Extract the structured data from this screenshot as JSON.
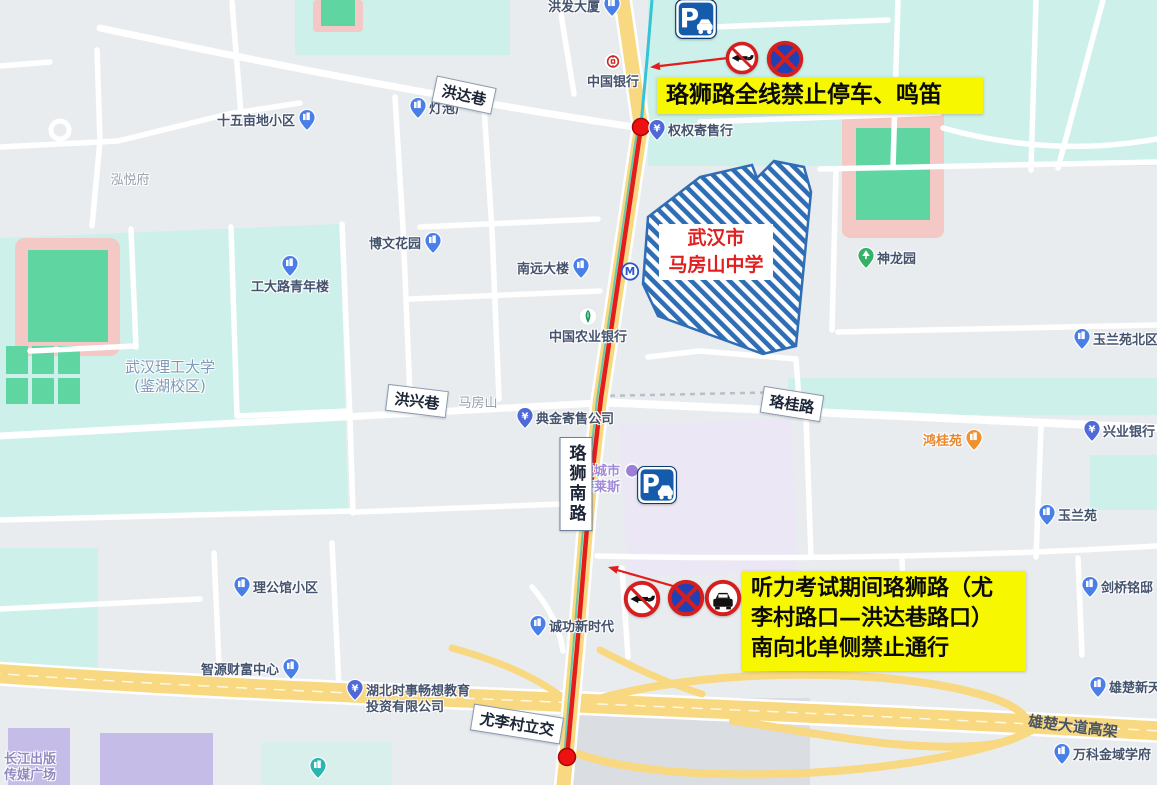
{
  "colors": {
    "map_background": "#e9ecef",
    "campus_teal": "#cdf0ea",
    "field_green": "#5fd6a2",
    "track_pink": "#f3c8c5",
    "mall_lavender": "#ebe7f5",
    "road_yellow": "#f8d880",
    "metro_cyan": "#35c3d5",
    "route_red": "#e31c1c",
    "note_yellow": "#f7f700",
    "school_hatch_blue": "#2f6db5",
    "school_text_red": "#e02020"
  },
  "school": {
    "label_lines": [
      "武汉市",
      "马房山中学"
    ]
  },
  "annotations": {
    "no_parking_horn": {
      "lines": [
        "珞狮路全线禁止停车、鸣笛"
      ]
    },
    "exam_closure": {
      "lines": [
        "听力考试期间珞狮路（尤",
        "李村路口—洪达巷路口）",
        "南向北单侧禁止通行"
      ]
    }
  },
  "road_labels": [
    {
      "name": "road-label-hongda-alley",
      "text": "洪达巷",
      "x": 464,
      "y": 95,
      "rot": 12,
      "style": "box"
    },
    {
      "name": "road-label-hongxing-alley",
      "text": "洪兴巷",
      "x": 417,
      "y": 401,
      "rot": 7,
      "style": "box"
    },
    {
      "name": "road-label-luogui-road",
      "text": "珞桂路",
      "x": 792,
      "y": 404,
      "rot": 9,
      "style": "box"
    },
    {
      "name": "road-label-luoshi-south-road",
      "text": "珞狮南路",
      "x": 576,
      "y": 484,
      "rot": 0,
      "style": "box-vertical"
    },
    {
      "name": "road-label-youlicun-interchange",
      "text": "尤李村立交",
      "x": 517,
      "y": 724,
      "rot": 9,
      "style": "box"
    },
    {
      "name": "road-label-xiongchu-avenue-viaduct",
      "text": "雄楚大道高架",
      "x": 1073,
      "y": 726,
      "rot": 7,
      "style": "on-road"
    }
  ],
  "pois": [
    {
      "name": "hongfa-building",
      "lines": [
        "洪发大厦"
      ],
      "icon": "drop-building",
      "x": 612,
      "y": 8,
      "side": "left"
    },
    {
      "name": "bank-of-china",
      "lines": [
        "中国银行"
      ],
      "icon": "circle-boc",
      "x": 613,
      "y": 63,
      "side": "below"
    },
    {
      "name": "quanquan-consignment-shop",
      "lines": [
        "权权寄售行"
      ],
      "icon": "drop-yen",
      "x": 657,
      "y": 132,
      "side": "right"
    },
    {
      "name": "dengpaochang",
      "lines": [
        "灯泡厂"
      ],
      "icon": "drop-building",
      "x": 418,
      "y": 110,
      "side": "right"
    },
    {
      "name": "shiwumudi-community",
      "lines": [
        "十五亩地小区"
      ],
      "icon": "drop-building",
      "x": 307,
      "y": 122,
      "side": "left"
    },
    {
      "name": "hongyuefu",
      "lines": [
        "泓悦府"
      ],
      "icon": "none",
      "x": 130,
      "y": 181,
      "side": "center",
      "cls": "gray"
    },
    {
      "name": "bowen-garden",
      "lines": [
        "博文花园"
      ],
      "icon": "drop-building",
      "x": 433,
      "y": 245,
      "side": "left"
    },
    {
      "name": "gongdalu-youth-building",
      "lines": [
        "工大路青年楼"
      ],
      "icon": "drop-building",
      "x": 290,
      "y": 268,
      "side": "below"
    },
    {
      "name": "wuhan-university-of-technology",
      "lines": [
        "武汉理工大学",
        "(鉴湖校区)"
      ],
      "icon": "none",
      "x": 170,
      "y": 377,
      "side": "center",
      "cls": "campus"
    },
    {
      "name": "nanyuan-building",
      "lines": [
        "南远大楼"
      ],
      "icon": "drop-building",
      "x": 581,
      "y": 270,
      "side": "left"
    },
    {
      "name": "agricultural-bank-of-china",
      "lines": [
        "中国农业银行"
      ],
      "icon": "circle-abc",
      "x": 588,
      "y": 318,
      "side": "below"
    },
    {
      "name": "metro-station",
      "lines": [],
      "icon": "circle-metro",
      "x": 630,
      "y": 273,
      "side": "right"
    },
    {
      "name": "mafangshan",
      "lines": [
        "马房山"
      ],
      "icon": "none",
      "x": 478,
      "y": 404,
      "side": "center",
      "cls": "gray"
    },
    {
      "name": "dianjin-consignment-company",
      "lines": [
        "典金寄售公司"
      ],
      "icon": "drop-yen",
      "x": 525,
      "y": 420,
      "side": "right"
    },
    {
      "name": "yuecheng-telaisi-mall",
      "lines": [
        "悦城市",
        "特莱斯"
      ],
      "icon": "circle-purple",
      "x": 632,
      "y": 472,
      "side": "left",
      "cls": "mall"
    },
    {
      "name": "honggui-garden",
      "lines": [
        "鸿桂苑"
      ],
      "icon": "drop-orange",
      "x": 974,
      "y": 442,
      "side": "left",
      "cls": "orange"
    },
    {
      "name": "industrial-bank",
      "lines": [
        "兴业银行"
      ],
      "icon": "drop-yen",
      "x": 1092,
      "y": 433,
      "side": "right"
    },
    {
      "name": "yulanyuan-north-community",
      "lines": [
        "玉兰苑北区"
      ],
      "icon": "drop-building",
      "x": 1082,
      "y": 341,
      "side": "right"
    },
    {
      "name": "shenlong-park",
      "lines": [
        "神龙园"
      ],
      "icon": "drop-park",
      "x": 866,
      "y": 260,
      "side": "right"
    },
    {
      "name": "yulanyuan-community",
      "lines": [
        "玉兰苑"
      ],
      "icon": "drop-building",
      "x": 1047,
      "y": 517,
      "side": "right"
    },
    {
      "name": "jianqiao-mingdi",
      "lines": [
        "剑桥铭邸"
      ],
      "icon": "drop-building",
      "x": 1090,
      "y": 589,
      "side": "right"
    },
    {
      "name": "ligongguan-community",
      "lines": [
        "理公馆小区"
      ],
      "icon": "drop-building",
      "x": 242,
      "y": 589,
      "side": "right"
    },
    {
      "name": "zhiyuan-wealth-center",
      "lines": [
        "智源财富中心"
      ],
      "icon": "drop-building",
      "x": 291,
      "y": 671,
      "side": "left"
    },
    {
      "name": "chenggong-new-era",
      "lines": [
        "诚功新时代"
      ],
      "icon": "drop-building",
      "x": 538,
      "y": 628,
      "side": "right"
    },
    {
      "name": "hubei-education-investment-co",
      "lines": [
        "湖北时事畅想教育",
        "投资有限公司"
      ],
      "icon": "drop-yen",
      "x": 355,
      "y": 692,
      "side": "right"
    },
    {
      "name": "xiongchu-xintiandi",
      "lines": [
        "雄楚新天地"
      ],
      "icon": "drop-building",
      "x": 1098,
      "y": 689,
      "side": "right"
    },
    {
      "name": "vanke-jinyu-xuefu",
      "lines": [
        "万科金域学府"
      ],
      "icon": "drop-building",
      "x": 1062,
      "y": 756,
      "side": "right"
    },
    {
      "name": "changjiang-publishing-media-plaza",
      "lines": [
        "长江出版",
        "传媒广场"
      ],
      "icon": "none",
      "x": 30,
      "y": 768,
      "side": "center",
      "cls": "purple"
    },
    {
      "name": "unnamed-community-poi",
      "lines": [],
      "icon": "drop-building",
      "x": 999,
      "y": 625,
      "side": "right"
    },
    {
      "name": "unnamed-teal-poi",
      "lines": [],
      "icon": "drop-teal",
      "x": 318,
      "y": 770,
      "side": "right"
    }
  ],
  "signs": [
    {
      "name": "parking-sign-top",
      "icon": "parking",
      "x": 696,
      "y": 21,
      "size": 44
    },
    {
      "name": "no-horn-sign-top",
      "icon": "no-horn",
      "x": 742,
      "y": 60,
      "size": 35
    },
    {
      "name": "no-stopping-sign-top",
      "icon": "no-stopping",
      "x": 785,
      "y": 61,
      "size": 39
    },
    {
      "name": "parking-sign-mall",
      "icon": "parking",
      "x": 657,
      "y": 487,
      "size": 42
    },
    {
      "name": "no-horn-sign-bottom",
      "icon": "no-horn",
      "x": 642,
      "y": 601,
      "size": 39
    },
    {
      "name": "no-stopping-sign-bottom",
      "icon": "no-stopping",
      "x": 686,
      "y": 600,
      "size": 39
    },
    {
      "name": "no-vehicle-sign-bottom",
      "icon": "no-vehicles",
      "x": 723,
      "y": 600,
      "size": 39
    }
  ]
}
